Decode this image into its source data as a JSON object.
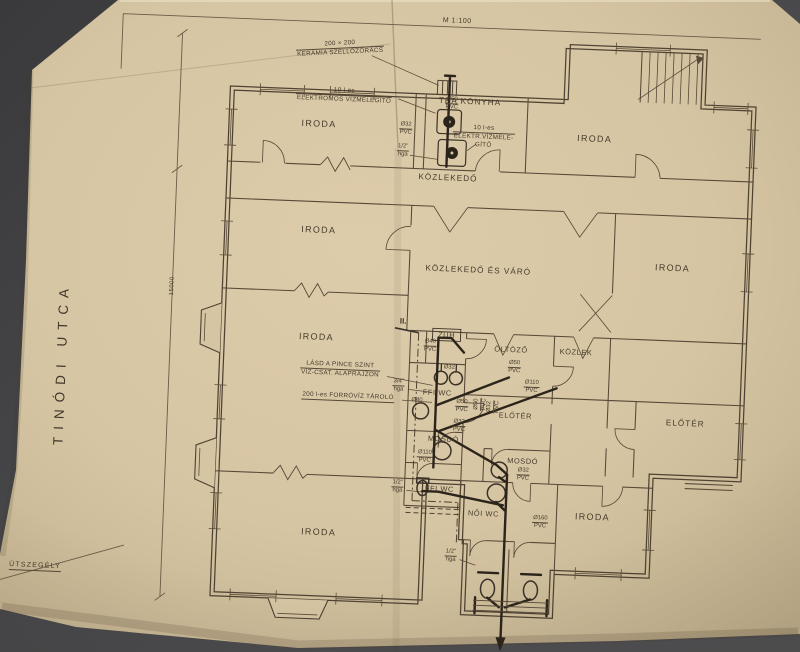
{
  "photo": {
    "background_color": "#47474a",
    "paper_color": "#d6c5a3",
    "line_color": "#574838",
    "pipe_color": "#2b241b"
  },
  "plan": {
    "scale_note": "M 1:100",
    "street_name": "TINÓDI UTCA",
    "curb_label": "ÚTSZEGÉLY",
    "dimension": "15000",
    "section_marker": "II.",
    "rooms": [
      {
        "id": "iroda-top-left",
        "label": "IRODA",
        "x": 312,
        "y": 127
      },
      {
        "id": "tea-konyha",
        "label": "TEA KONYHA",
        "x": 462,
        "y": 99
      },
      {
        "id": "iroda-top-right",
        "label": "IRODA",
        "x": 588,
        "y": 131
      },
      {
        "id": "kozlekedo",
        "label": "KÖZLEKEDŐ",
        "x": 443,
        "y": 176
      },
      {
        "id": "iroda-mid-left",
        "label": "IRODA",
        "x": 316,
        "y": 233
      },
      {
        "id": "kozlekedo-es-varo",
        "label": "KÖZLEKEDŐ ÉS VÁRÓ",
        "x": 477,
        "y": 267
      },
      {
        "id": "iroda-mid-right",
        "label": "IRODA",
        "x": 671,
        "y": 257
      },
      {
        "id": "iroda-lower-left",
        "label": "IRODA",
        "x": 318,
        "y": 340
      },
      {
        "id": "zuh",
        "label": "ZUH",
        "x": 448,
        "y": 333
      },
      {
        "id": "oltozo",
        "label": "ÖLTÖZŐ",
        "x": 513,
        "y": 345
      },
      {
        "id": "kozlek",
        "label": "KÖZLEK",
        "x": 578,
        "y": 345
      },
      {
        "id": "ffi-wc-upper",
        "label": "FFI WC",
        "x": 441,
        "y": 391
      },
      {
        "id": "eloter-middle",
        "label": "ELŐTÉR",
        "x": 520,
        "y": 411
      },
      {
        "id": "mosdo-1",
        "label": "MOSDÓ",
        "x": 449,
        "y": 437
      },
      {
        "id": "mosdo-2",
        "label": "MOSDÓ",
        "x": 529,
        "y": 456
      },
      {
        "id": "eloter-right",
        "label": "ELŐTÉR",
        "x": 690,
        "y": 412
      },
      {
        "id": "ffi-wc-lower",
        "label": "FFI WC",
        "x": 447,
        "y": 487
      },
      {
        "id": "noi-wc",
        "label": "NŐI WC",
        "x": 492,
        "y": 510
      },
      {
        "id": "iroda-bottom-right",
        "label": "IRODA",
        "x": 601,
        "y": 509
      },
      {
        "id": "iroda-bottom-left",
        "label": "IRODA",
        "x": 328,
        "y": 535
      }
    ],
    "annotations": [
      {
        "id": "ann-vent",
        "lines": [
          "200 × 200",
          "KERÁMIA SZELLŐZŐRÁCS"
        ],
        "rule_after": 1,
        "x": 330,
        "y": 51
      },
      {
        "id": "ann-heater-left",
        "lines": [
          "10 l-es",
          "ELEKTROMOS VÍZMELEGÍTŐ"
        ],
        "rule_after": 1,
        "x": 336,
        "y": 98
      },
      {
        "id": "ann-heater-right",
        "lines": [
          "10 l-es",
          "ELEKTR.VÍZMELE-",
          "GÍTŐ"
        ],
        "rule_after": 1,
        "x": 477,
        "y": 134
      },
      {
        "id": "ann-lasd",
        "lines": [
          "LÁSD A PINCE SZINT",
          "VÍZ-CSAT. ALAPRAJZON"
        ],
        "rule_after": 1,
        "x": 343,
        "y": 372
      },
      {
        "id": "ann-forroviz",
        "lines": [
          "200 l-es FORRÓVÍZ TÁROLÓ"
        ],
        "rule_after": 1,
        "x": 352,
        "y": 399
      }
    ],
    "pipe_labels": [
      {
        "id": "pl-tea-sink",
        "d": "Ø50",
        "m": "PVC",
        "x": 444,
        "y": 102
      },
      {
        "id": "pl-tea-32",
        "d": "Ø32",
        "m": "PVC",
        "x": 399,
        "y": 129
      },
      {
        "id": "pl-tea-hga",
        "d": "1/2\"",
        "m": "hga",
        "x": 397,
        "y": 151
      },
      {
        "id": "pl-zuh-40",
        "d": "Ø40",
        "m": "PVC",
        "x": 432,
        "y": 345
      },
      {
        "id": "pl-oltozo-50",
        "d": "Ø50",
        "m": "PVC",
        "x": 517,
        "y": 363
      },
      {
        "id": "pl-kozlek-110",
        "d": "Ø110",
        "m": "PVC",
        "x": 535,
        "y": 382
      },
      {
        "id": "pl-tarolo-hga",
        "d": "3/4\"",
        "m": "hga",
        "x": 402,
        "y": 386
      },
      {
        "id": "pl-ffi-50",
        "d": "Ø50",
        "m": "PVC",
        "x": 466,
        "y": 404
      },
      {
        "id": "pl-ffi-urinal-32",
        "d": "Ø32",
        "m": null,
        "x": 452,
        "y": 366
      },
      {
        "id": "pl-ffi-sink-40",
        "d": "Ø40",
        "m": null,
        "x": 421,
        "y": 400
      },
      {
        "id": "pl-ffi-vert-50",
        "d": "Ø50",
        "m": "PVC",
        "x": 485,
        "y": 401
      },
      {
        "id": "pl-ffi-vert-32",
        "d": "Ø32",
        "m": "PVC",
        "x": 498,
        "y": 403
      },
      {
        "id": "pl-mosdo1-32",
        "d": "Ø32",
        "m": "PVC",
        "x": 464,
        "y": 424
      },
      {
        "id": "pl-mosdo1-110",
        "d": "Ø110",
        "m": "PVC",
        "x": 431,
        "y": 456
      },
      {
        "id": "pl-mosdo2-32",
        "d": "Ø32",
        "m": "PVC",
        "x": 530,
        "y": 470
      },
      {
        "id": "pl-ffi2-hga",
        "d": "1/2\"",
        "m": "hga",
        "x": 405,
        "y": 487
      },
      {
        "id": "pl-noi-160",
        "d": "Ø160",
        "m": "PVC",
        "x": 549,
        "y": 517
      },
      {
        "id": "pl-wc-hga",
        "d": "1/2\"",
        "m": "hga",
        "x": 461,
        "y": 554
      }
    ]
  }
}
